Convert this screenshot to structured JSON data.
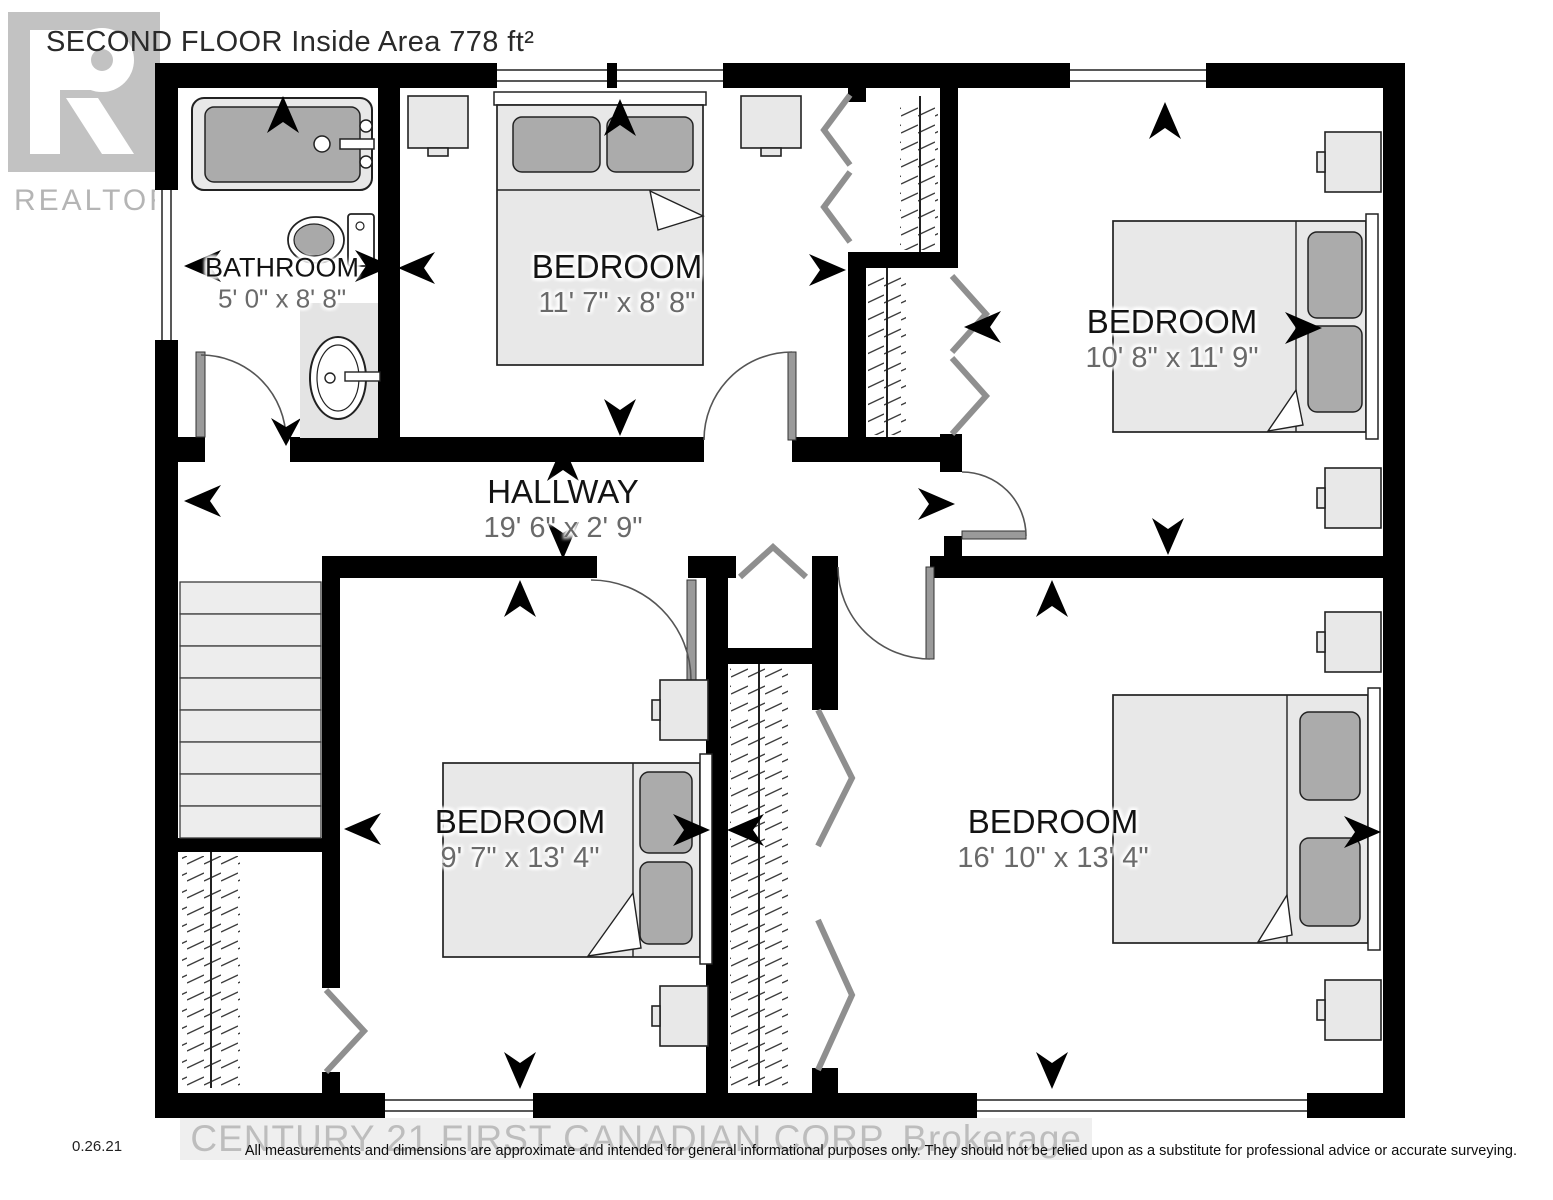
{
  "title": "SECOND FLOOR Inside Area 778 ft²",
  "logo": {
    "brand": "REALTOR",
    "registered": "®"
  },
  "rooms": {
    "bathroom": {
      "name": "BATHROOM",
      "dims": "5' 0\" x 8' 8\""
    },
    "bedroom_top": {
      "name": "BEDROOM",
      "dims": "11' 7\" x 8' 8\""
    },
    "bedroom_right": {
      "name": "BEDROOM",
      "dims": "10' 8\" x 11' 9\""
    },
    "hallway": {
      "name": "HALLWAY",
      "dims": "19' 6\" x 2' 9\""
    },
    "bedroom_bottom_left": {
      "name": "BEDROOM",
      "dims": "9' 7\" x 13' 4\""
    },
    "bedroom_bottom_right": {
      "name": "BEDROOM",
      "dims": "16' 10\" x 13' 4\""
    }
  },
  "footer": {
    "version": "0.26.21",
    "watermark": "CENTURY 21 FIRST CANADIAN CORP. Brokerage",
    "disclaimer": "All measurements and dimensions are approximate and intended for general informational purposes only. They should not be relied upon as a substitute for professional advice or accurate surveying."
  }
}
